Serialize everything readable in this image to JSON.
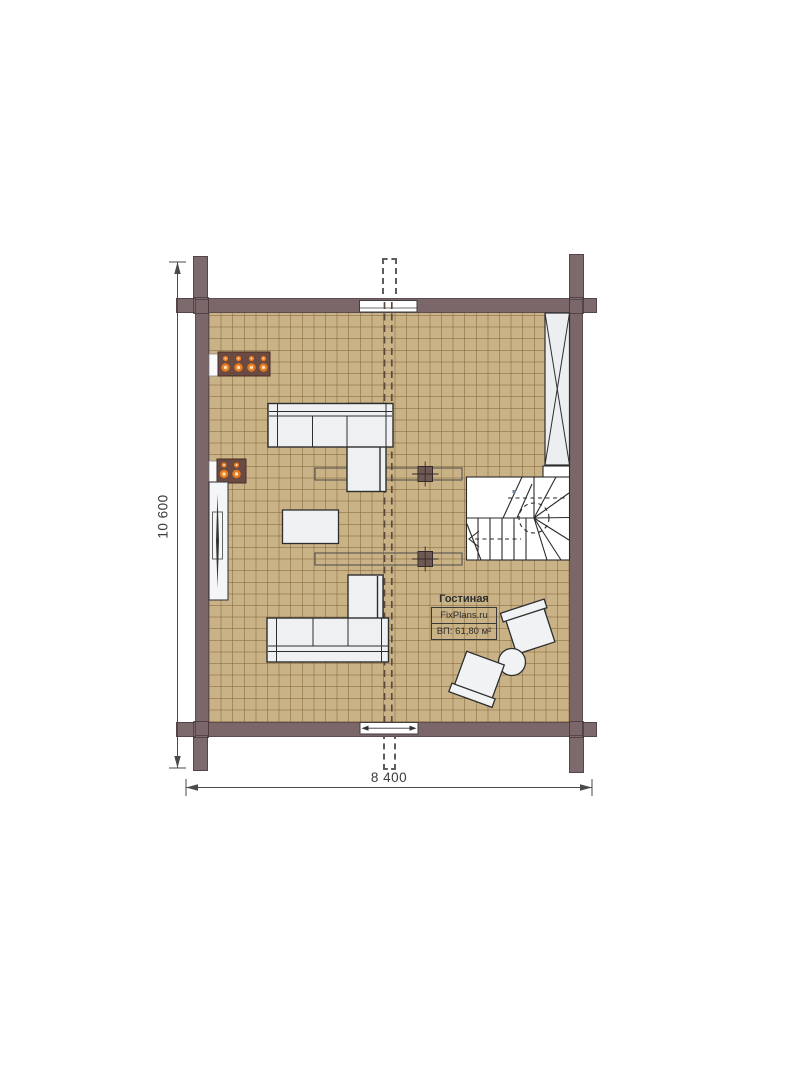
{
  "meta": {
    "title": "Floor plan — living room level",
    "source_brand": "FixPlans.ru"
  },
  "labels": {
    "room_name": "Гостиная",
    "brand": "FixPlans.ru",
    "area": "ВП: 61,80 м²",
    "width_dim": "8 400",
    "height_dim": "10 600"
  },
  "colors": {
    "wall": "#7b666a",
    "post_outline": "#54454a",
    "floor": "#c9b286",
    "tile_grid_line": "#806138",
    "furniture_fill": "#eef0f1",
    "furniture_stroke": "#2e2e2e",
    "flame_orange": "#e87b20",
    "stove_body": "#6b4a42",
    "dimension_line": "#4a4a4a"
  },
  "furniture": [
    {
      "icon": "candle-fireplace-icon",
      "flames": 4
    },
    {
      "icon": "wall-candles-icon",
      "flames": 2
    },
    {
      "icon": "tv-sideboard-icon"
    },
    {
      "icon": "corner-sofa-icon",
      "position": "upper"
    },
    {
      "icon": "corner-sofa-icon",
      "position": "lower"
    },
    {
      "icon": "coffee-table-icon"
    },
    {
      "icon": "wardrobe-x-icon"
    },
    {
      "icon": "winder-staircase-icon"
    },
    {
      "icon": "armchair-icon",
      "position": "right-upper"
    },
    {
      "icon": "armchair-icon",
      "position": "right-lower"
    },
    {
      "icon": "round-side-table-icon"
    },
    {
      "icon": "beam-with-column-icon",
      "position": "upper"
    },
    {
      "icon": "beam-with-column-icon",
      "position": "lower"
    },
    {
      "icon": "window-icon",
      "position": "top-wall"
    },
    {
      "icon": "window-icon",
      "position": "bottom-wall"
    },
    {
      "icon": "chimney-dashed-outline-icon",
      "position": "top"
    },
    {
      "icon": "ridge-dashed-line-icon",
      "position": "center"
    }
  ]
}
